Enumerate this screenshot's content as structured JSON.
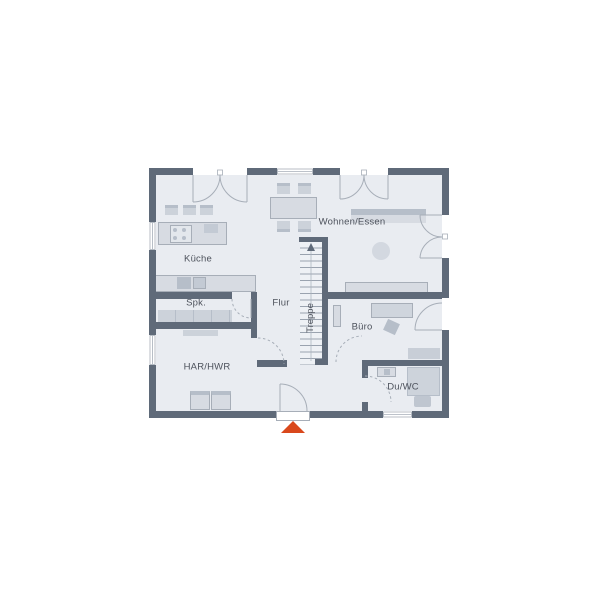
{
  "floorplan": {
    "title": "Erdgeschoss Grundriss",
    "rooms": [
      {
        "id": "kueche",
        "label": "Küche"
      },
      {
        "id": "wohnen-essen",
        "label": "Wohnen/Essen"
      },
      {
        "id": "spk",
        "label": "Spk."
      },
      {
        "id": "flur",
        "label": "Flur"
      },
      {
        "id": "treppe",
        "label": "Treppe"
      },
      {
        "id": "buero",
        "label": "Büro"
      },
      {
        "id": "har-hwr",
        "label": "HAR/HWR"
      },
      {
        "id": "du-wc",
        "label": "Du/WC"
      }
    ],
    "markers": {
      "entrance": "entrance-arrow",
      "stairs_up": "stairs-direction-arrow"
    },
    "colors": {
      "wall": "#5f6a79",
      "floor": "#e9ecf1",
      "furniture_light": "#d7dbe2",
      "furniture_mid": "#ccd2da",
      "furniture_dark": "#b6bec9",
      "outline": "#a7aeb8",
      "stair_tread": "#9aa3af",
      "text": "#4d525c",
      "entrance_marker": "#d9481c"
    }
  }
}
